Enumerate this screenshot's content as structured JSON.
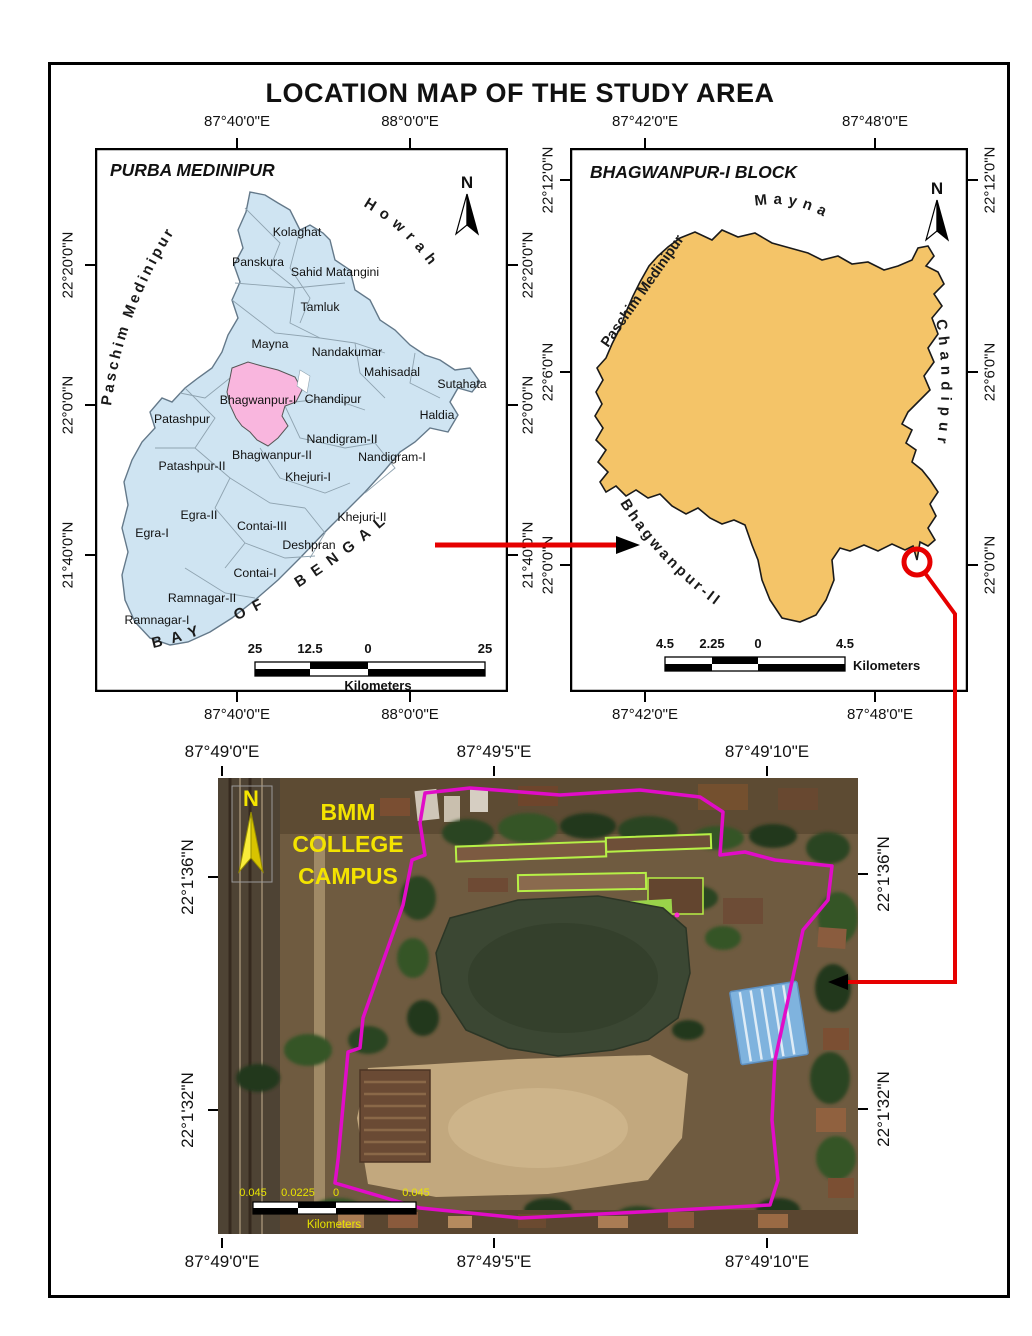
{
  "title": "LOCATION MAP OF THE STUDY AREA",
  "left_map": {
    "title": "PURBA MEDINIPUR",
    "north": "N",
    "neighbors": {
      "west": "Paschim Medinipur",
      "northeast": "Howrah",
      "sea": "BAY OF BENGAL"
    },
    "highlight_block": "Bhagwanpur-I",
    "blocks": [
      "Kolaghat",
      "Panskura",
      "Sahid Matangini",
      "Tamluk",
      "Mayna",
      "Nandakumar",
      "Mahisadal",
      "Sutahata",
      "Haldia",
      "Bhagwanpur-I",
      "Chandipur",
      "Patashpur",
      "Nandigram-II",
      "Bhagwanpur-II",
      "Nandigram-I",
      "Patashpur-II",
      "Khejuri-I",
      "Egra-II",
      "Contai-III",
      "Khejuri-II",
      "Egra-I",
      "Deshpran",
      "Contai-I",
      "Ramnagar-II",
      "Ramnagar-I"
    ],
    "scale": {
      "labels": [
        "25",
        "12.5",
        "0",
        "25"
      ],
      "unit": "Kilometers"
    },
    "x_ticks": [
      "87°40'0\"E",
      "88°0'0\"E"
    ],
    "y_ticks": [
      "22°20'0\"N",
      "22°0'0\"N",
      "21°40'0\"N"
    ]
  },
  "right_map": {
    "title": "BHAGWANPUR-I BLOCK",
    "north": "N",
    "neighbors": {
      "north": "Mayna",
      "west": "Paschim Medinipur",
      "east": "Chandipur",
      "southwest": "Bhagwanpur-II"
    },
    "scale": {
      "labels": [
        "4.5",
        "2.25",
        "0",
        "4.5"
      ],
      "unit": "Kilometers"
    },
    "x_ticks": [
      "87°42'0\"E",
      "87°48'0\"E"
    ],
    "y_ticks": [
      "22°12'0\"N",
      "22°6'0\"N",
      "22°0'0\"N"
    ]
  },
  "site_map": {
    "caption": [
      "BMM",
      "COLLEGE",
      "CAMPUS"
    ],
    "north": "N",
    "scale": {
      "labels": [
        "0.045",
        "0.0225",
        "0",
        "0.045"
      ],
      "unit": "Kilometers"
    },
    "x_ticks": [
      "87°49'0\"E",
      "87°49'5\"E",
      "87°49'10\"E"
    ],
    "y_ticks": [
      "22°1'36\"N",
      "22°1'32\"N"
    ]
  },
  "colors": {
    "district_fill": "#cfe4f2",
    "highlight_fill": "#f9b6de",
    "block_fill": "#f4c468",
    "marker_red": "#e60000",
    "boundary_magenta": "#e10cc8",
    "annotation_yellow": "#f4e400"
  }
}
